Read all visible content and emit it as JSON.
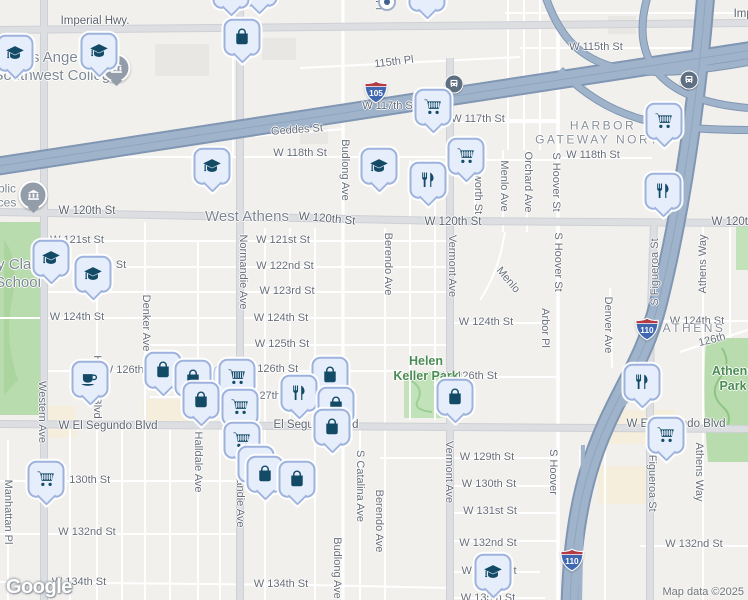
{
  "logo_text": "Google",
  "attribution": {
    "text": "Map data ©2025"
  },
  "colors": {
    "marker_fill": "#e6edfb",
    "marker_border": "#9db2dc",
    "marker_glyph": "#134b66",
    "freeway": "#9fb3ca",
    "park": "#bfe0b4",
    "park_label": "#4b8b54",
    "shield_blue": "#4068b0",
    "shield_red": "#b73a42"
  },
  "shields": [
    {
      "route": "105",
      "x": 376,
      "y": 92
    },
    {
      "route": "110",
      "x": 647,
      "y": 329
    },
    {
      "route": "110",
      "x": 572,
      "y": 560
    }
  ],
  "transit_icons": [
    {
      "x": 454,
      "y": 84
    },
    {
      "x": 689,
      "y": 80
    }
  ],
  "civic_icons": [
    {
      "glyph": "museum",
      "x": 116,
      "y": 68
    },
    {
      "glyph": "museum",
      "x": 33,
      "y": 195
    }
  ],
  "area_labels": [
    {
      "text": "Los Angeles\nSouthwest College",
      "x": 56,
      "y": 67,
      "cls": "poi-big"
    },
    {
      "text": "blic\nces",
      "x": 7,
      "y": 196,
      "cls": "poi-sm"
    },
    {
      "text": "y Clay\nSchool",
      "x": 18,
      "y": 274,
      "cls": "poi-big"
    },
    {
      "text": "West Athens",
      "x": 247,
      "y": 217,
      "cls": "city"
    },
    {
      "text": "HARBOR\nGATEWAY NORTH",
      "x": 603,
      "y": 133,
      "cls": "district"
    },
    {
      "text": "ATHENS",
      "x": 694,
      "y": 328,
      "cls": "district"
    },
    {
      "text": "Helen\nKeller Park",
      "x": 426,
      "y": 369,
      "cls": "park"
    },
    {
      "text": "Athens Park",
      "x": 733,
      "y": 379,
      "cls": "park"
    }
  ],
  "street_labels": [
    {
      "t": "Imperial Hwy.",
      "x": 95,
      "y": 21,
      "r": 0,
      "cls": "arterial"
    },
    {
      "t": "Imperial Hwy.",
      "x": 768,
      "y": 14,
      "r": 0,
      "cls": "arterial"
    },
    {
      "t": "115th Pl",
      "x": 394,
      "y": 62,
      "r": -7
    },
    {
      "t": "W 115th St",
      "x": 596,
      "y": 47,
      "r": 0
    },
    {
      "t": "W 117th St",
      "x": 389,
      "y": 106,
      "r": 0
    },
    {
      "t": "W 117th St",
      "x": 478,
      "y": 119,
      "r": 0
    },
    {
      "t": "Geddes St",
      "x": 297,
      "y": 130,
      "r": -4
    },
    {
      "t": "W 118th St",
      "x": 300,
      "y": 153,
      "r": 0
    },
    {
      "t": "W 118th St",
      "x": 593,
      "y": 155,
      "r": 0
    },
    {
      "t": "Pl",
      "x": 379,
      "y": 5,
      "r": 90
    },
    {
      "t": "W 120th St",
      "x": 87,
      "y": 211,
      "r": 0,
      "cls": "arterial"
    },
    {
      "t": "W 120th St",
      "x": 327,
      "y": 219,
      "r": 5,
      "cls": "arterial"
    },
    {
      "t": "W 120th St",
      "x": 453,
      "y": 222,
      "r": 0,
      "cls": "arterial"
    },
    {
      "t": "W 120th St",
      "x": 740,
      "y": 222,
      "r": 0,
      "cls": "arterial"
    },
    {
      "t": "W 121st St",
      "x": 77,
      "y": 240,
      "r": 0
    },
    {
      "t": "W 121st St",
      "x": 283,
      "y": 240,
      "r": 0
    },
    {
      "t": "St",
      "x": 121,
      "y": 265,
      "r": 0
    },
    {
      "t": "W 122nd St",
      "x": 285,
      "y": 266,
      "r": 0
    },
    {
      "t": "W 123rd St",
      "x": 287,
      "y": 291,
      "r": 0
    },
    {
      "t": "W 124th St",
      "x": 77,
      "y": 317,
      "r": 0
    },
    {
      "t": "W 124th St",
      "x": 281,
      "y": 318,
      "r": 0
    },
    {
      "t": "W 124th St",
      "x": 486,
      "y": 322,
      "r": 0
    },
    {
      "t": "W 124th St",
      "x": 697,
      "y": 321,
      "r": 0
    },
    {
      "t": "W 125th St",
      "x": 282,
      "y": 344,
      "r": 0
    },
    {
      "t": "W 126th St",
      "x": 130,
      "y": 370,
      "r": 0
    },
    {
      "t": "W 126th St",
      "x": 271,
      "y": 369,
      "r": 0
    },
    {
      "t": "W 126th St",
      "x": 470,
      "y": 376,
      "r": 0
    },
    {
      "t": "126th",
      "x": 712,
      "y": 340,
      "r": -14
    },
    {
      "t": "W 127th St",
      "x": 267,
      "y": 396,
      "r": 0
    },
    {
      "t": "W El Segundo Blvd",
      "x": 108,
      "y": 426,
      "r": 0,
      "cls": "arterial"
    },
    {
      "t": "El Segundo Blvd",
      "x": 316,
      "y": 425,
      "r": 0,
      "cls": "arterial"
    },
    {
      "t": "W El Segundo Blvd",
      "x": 676,
      "y": 424,
      "r": 0,
      "cls": "arterial"
    },
    {
      "t": "W 129th St",
      "x": 487,
      "y": 457,
      "r": 0
    },
    {
      "t": "W 130th St",
      "x": 83,
      "y": 480,
      "r": 0
    },
    {
      "t": "W 130th St",
      "x": 489,
      "y": 484,
      "r": 0
    },
    {
      "t": "W 131st St",
      "x": 490,
      "y": 511,
      "r": 0
    },
    {
      "t": "W 132nd St",
      "x": 87,
      "y": 532,
      "r": 0
    },
    {
      "t": "W 132nd St",
      "x": 488,
      "y": 543,
      "r": 0
    },
    {
      "t": "W 132nd St",
      "x": 694,
      "y": 544,
      "r": 0
    },
    {
      "t": "W 133rd St",
      "x": 489,
      "y": 571,
      "r": 0
    },
    {
      "t": "W 134th St",
      "x": 79,
      "y": 582,
      "r": 0
    },
    {
      "t": "W 134th St",
      "x": 281,
      "y": 584,
      "r": 0
    },
    {
      "t": "W 135th St",
      "x": 488,
      "y": 598,
      "r": 0
    },
    {
      "t": "Manhattan Pl",
      "x": 8,
      "y": 512,
      "r": 90
    },
    {
      "t": "Western Ave",
      "x": 42,
      "y": 412,
      "r": 90
    },
    {
      "t": "Harvard Blvd",
      "x": 97,
      "y": 387,
      "r": 90
    },
    {
      "t": "Denker Ave",
      "x": 146,
      "y": 323,
      "r": 90
    },
    {
      "t": "Halldale Ave",
      "x": 198,
      "y": 462,
      "r": 90
    },
    {
      "t": "Normandie Ave",
      "x": 243,
      "y": 272,
      "r": 90
    },
    {
      "t": "Normandie Ave",
      "x": 240,
      "y": 490,
      "r": 90
    },
    {
      "t": "Budlong Ave",
      "x": 345,
      "y": 170,
      "r": 90
    },
    {
      "t": "Budlong Ave",
      "x": 337,
      "y": 568,
      "r": 90
    },
    {
      "t": "S Catalina Ave",
      "x": 360,
      "y": 486,
      "r": 90
    },
    {
      "t": "Berendo Ave",
      "x": 388,
      "y": 264,
      "r": 90
    },
    {
      "t": "Berendo Ave",
      "x": 379,
      "y": 521,
      "r": 90
    },
    {
      "t": "Vermont Ave",
      "x": 452,
      "y": 266,
      "r": 90
    },
    {
      "t": "Vermont Ave",
      "x": 449,
      "y": 472,
      "r": 90
    },
    {
      "t": "worth St",
      "x": 478,
      "y": 194,
      "r": 90
    },
    {
      "t": "Menlo Ave",
      "x": 504,
      "y": 186,
      "r": 90
    },
    {
      "t": "Menlo",
      "x": 508,
      "y": 280,
      "r": 50
    },
    {
      "t": "Orchard Ave",
      "x": 528,
      "y": 182,
      "r": 90
    },
    {
      "t": "S Hoover St",
      "x": 556,
      "y": 182,
      "r": 90
    },
    {
      "t": "S Hoover St",
      "x": 558,
      "y": 262,
      "r": 90
    },
    {
      "t": "S Hoover",
      "x": 553,
      "y": 472,
      "r": 90
    },
    {
      "t": "Arbor Pl",
      "x": 545,
      "y": 328,
      "r": 90
    },
    {
      "t": "Denver Ave",
      "x": 608,
      "y": 325,
      "r": 90
    },
    {
      "t": "S Figueroa St",
      "x": 655,
      "y": 272,
      "r": -90
    },
    {
      "t": "S Figueroa St",
      "x": 652,
      "y": 478,
      "r": 90
    },
    {
      "t": "Athens Way",
      "x": 703,
      "y": 264,
      "r": -90
    },
    {
      "t": "Athens Way",
      "x": 699,
      "y": 472,
      "r": 90
    }
  ],
  "markers": [
    {
      "g": "bag",
      "x": 259,
      "y": -8
    },
    {
      "g": "coffee",
      "x": 231,
      "y": -6
    },
    {
      "g": "food",
      "x": 427,
      "y": -3
    },
    {
      "g": "dot",
      "x": 387,
      "y": 2
    },
    {
      "g": "grad",
      "x": 99,
      "y": 55
    },
    {
      "g": "grad",
      "x": 15,
      "y": 57
    },
    {
      "g": "bag",
      "x": 242,
      "y": 41
    },
    {
      "g": "cart",
      "x": 433,
      "y": 111
    },
    {
      "g": "cart",
      "x": 664,
      "y": 125
    },
    {
      "g": "cart",
      "x": 466,
      "y": 160
    },
    {
      "g": "grad",
      "x": 212,
      "y": 170
    },
    {
      "g": "grad",
      "x": 379,
      "y": 170
    },
    {
      "g": "food",
      "x": 428,
      "y": 184
    },
    {
      "g": "food",
      "x": 663,
      "y": 195
    },
    {
      "g": "grad",
      "x": 51,
      "y": 262
    },
    {
      "g": "grad",
      "x": 93,
      "y": 278
    },
    {
      "g": "bag",
      "x": 163,
      "y": 374
    },
    {
      "g": "bag",
      "x": 330,
      "y": 379
    },
    {
      "g": "stack",
      "x": 237,
      "y": 381
    },
    {
      "g": "bag",
      "x": 193,
      "y": 382
    },
    {
      "g": "coffee",
      "x": 90,
      "y": 383
    },
    {
      "g": "food",
      "x": 642,
      "y": 386
    },
    {
      "g": "food",
      "x": 299,
      "y": 397
    },
    {
      "g": "bag",
      "x": 455,
      "y": 401
    },
    {
      "g": "bag",
      "x": 201,
      "y": 404
    },
    {
      "g": "bag",
      "x": 336,
      "y": 409
    },
    {
      "g": "cart",
      "x": 240,
      "y": 411
    },
    {
      "g": "bag",
      "x": 332,
      "y": 431
    },
    {
      "g": "cart",
      "x": 666,
      "y": 439
    },
    {
      "g": "cart",
      "x": 242,
      "y": 444
    },
    {
      "g": "bag",
      "x": 256,
      "y": 468
    },
    {
      "g": "bag",
      "x": 265,
      "y": 478
    },
    {
      "g": "cart",
      "x": 46,
      "y": 483
    },
    {
      "g": "bag",
      "x": 297,
      "y": 483
    },
    {
      "g": "grad",
      "x": 493,
      "y": 576
    }
  ]
}
